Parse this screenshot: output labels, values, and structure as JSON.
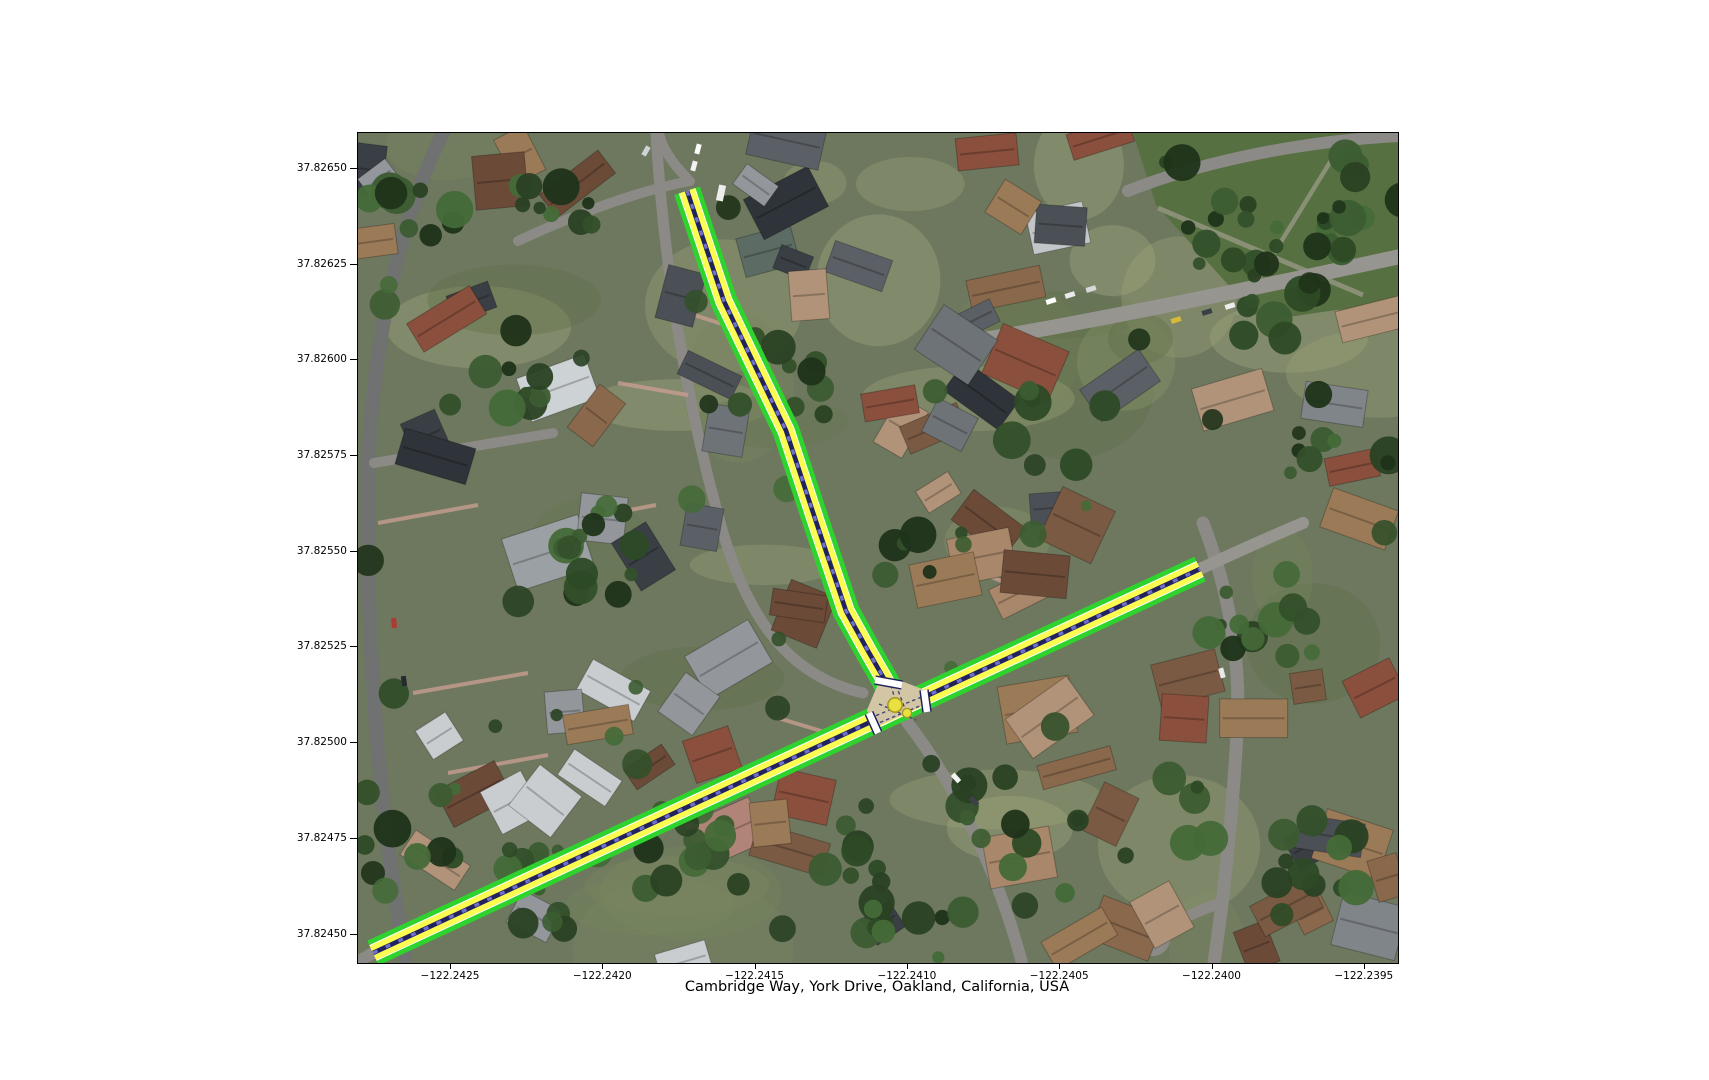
{
  "figure": {
    "title": "Cambridge Way, York Drive, Oakland, California, USA",
    "kind": "aerial street-network plot"
  },
  "axes": {
    "y_ticks": [
      "37.82650",
      "37.82625",
      "37.82600",
      "37.82575",
      "37.82550",
      "37.82525",
      "37.82500",
      "37.82475",
      "37.82450"
    ],
    "x_ticks": [
      "−122.2425",
      "−122.2420",
      "−122.2415",
      "−122.2410",
      "−122.2405",
      "−122.2400",
      "−122.2395"
    ]
  },
  "map_data": {
    "location": "Cambridge Way, York Drive, Oakland, California, USA",
    "bounds": {
      "west": -122.24281,
      "east": -122.23939,
      "north": 37.82659,
      "south": 37.82443
    },
    "roads": [
      {
        "id": "road-southwest-northeast",
        "polyline_lnglat": [
          [
            -122.242756,
            37.824452
          ],
          [
            -122.240041,
            37.825455
          ]
        ]
      },
      {
        "id": "road-north",
        "polyline_lnglat": [
          [
            -122.241725,
            37.826443
          ],
          [
            -122.241604,
            37.826155
          ],
          [
            -122.2414,
            37.825816
          ],
          [
            -122.241302,
            37.82558
          ],
          [
            -122.241203,
            37.825345
          ],
          [
            -122.241131,
            37.825241
          ],
          [
            -122.241078,
            37.825168
          ],
          [
            -122.241032,
            37.825097
          ]
        ]
      }
    ],
    "intersection": {
      "lnglat": [
        -122.241045,
        37.825105
      ],
      "node_count": 2
    },
    "style": {
      "edge_color": "#2ed32e",
      "lane_color": "#fbfb52",
      "centerline_color": "#22225e",
      "centerline_dash_color": "#6f6fd0",
      "node_color": "#e9e042",
      "crosswalk_color": "#ffffff"
    }
  }
}
